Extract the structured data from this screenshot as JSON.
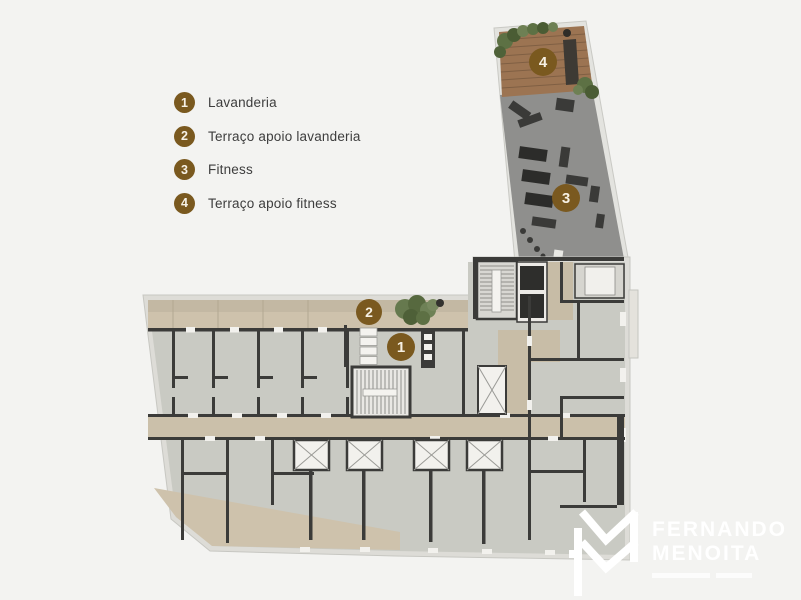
{
  "page": {
    "background": "#f3f3f1"
  },
  "colors": {
    "accent_brown": "#7a591f",
    "wall_dark": "#3b3b39",
    "plan_floor": "#c9cac3",
    "balcony_beige": "#cec2ac",
    "corridor_beige": "#cbc0aa",
    "wood_deck": "#9c7452",
    "fitness_floor": "#8f8f8d",
    "plant_green": "#5d7144",
    "logo_white": "#ffffff"
  },
  "legend": {
    "items": [
      {
        "number": "1",
        "label": "Lavanderia"
      },
      {
        "number": "2",
        "label": "Terraço apoio lavanderia"
      },
      {
        "number": "3",
        "label": "Fitness"
      },
      {
        "number": "4",
        "label": "Terraço apoio fitness"
      }
    ]
  },
  "plan_markers": [
    {
      "number": "1"
    },
    {
      "number": "2"
    },
    {
      "number": "3"
    },
    {
      "number": "4"
    }
  ],
  "logo": {
    "name_line1": "FERNANDO",
    "name_line2": "MENOITA"
  }
}
